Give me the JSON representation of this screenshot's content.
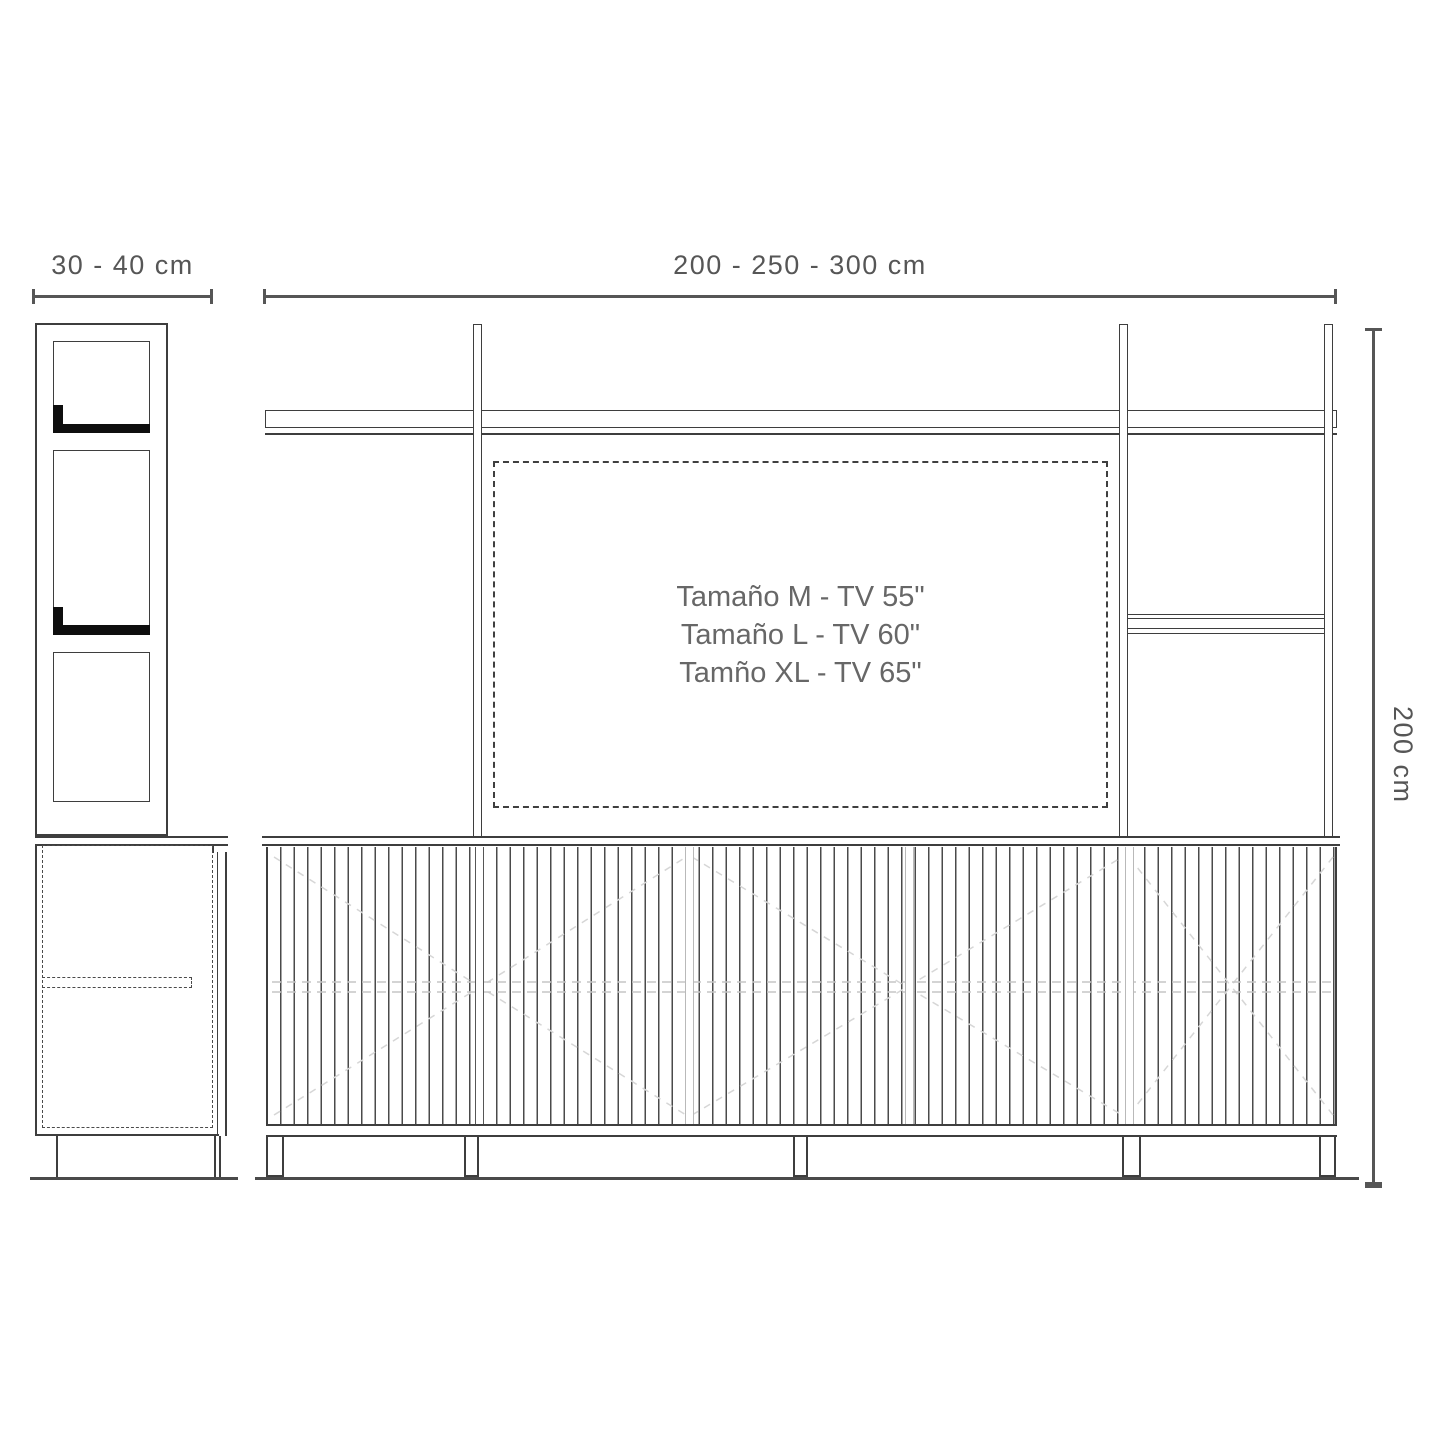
{
  "dimensions": {
    "depth_label": "30 - 40 cm",
    "width_label": "200 - 250 - 300 cm",
    "height_label": "200 cm"
  },
  "tv_size_note": {
    "line1": "Tamaño M - TV 55\"",
    "line2": "Tamaño L - TV 60\"",
    "line3": "Tamño XL - TV 65\""
  },
  "colors": {
    "line": "#3e3e3e",
    "dim": "#565656",
    "black": "#0e0e0e",
    "light": "#c8c8c8",
    "xlight": "#dadada",
    "tvtext": "#676767",
    "bg": "#ffffff"
  }
}
